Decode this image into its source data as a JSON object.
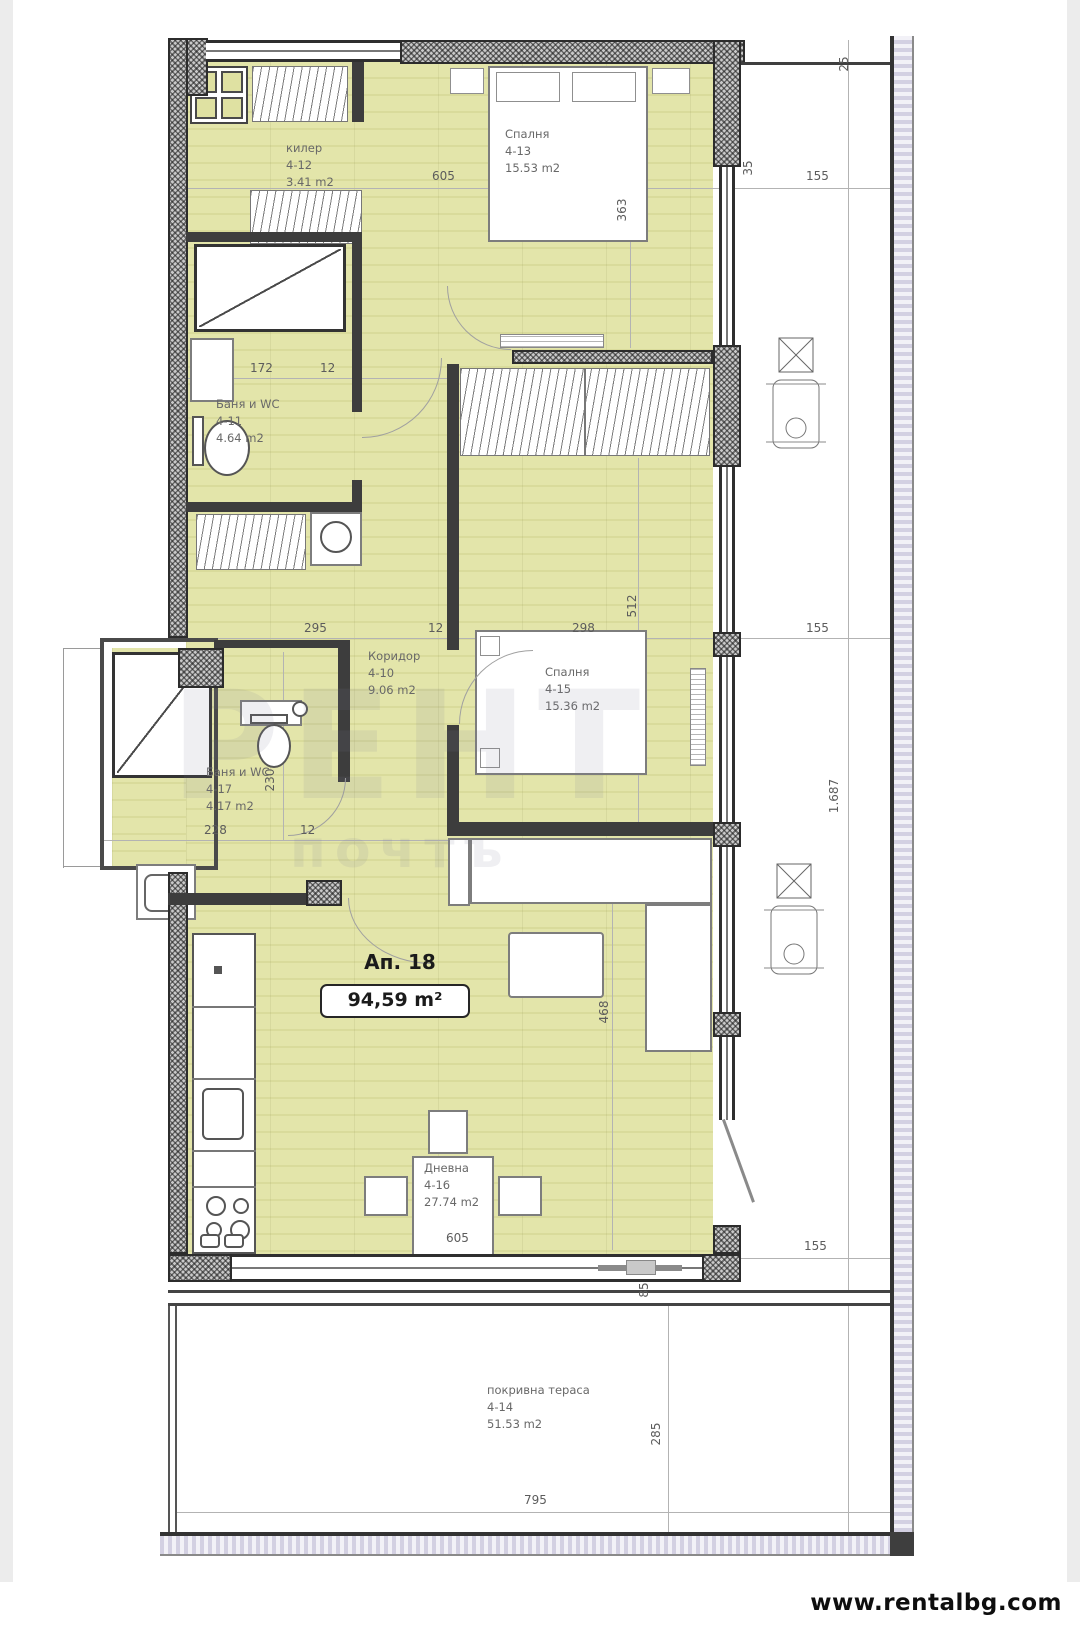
{
  "apartment": {
    "label": "Ап. 18",
    "area": "94,59 m²"
  },
  "rooms": [
    {
      "name": "килер",
      "code": "4-12",
      "area": "3.41 m2"
    },
    {
      "name": "Спалня",
      "code": "4-13",
      "area": "15.53 m2"
    },
    {
      "name": "Баня и WC",
      "code": "4-11",
      "area": "4.64 m2"
    },
    {
      "name": "Коридор",
      "code": "4-10",
      "area": "9.06 m2"
    },
    {
      "name": "Спалня",
      "code": "4-15",
      "area": "15.36 m2"
    },
    {
      "name": "Баня и WC",
      "code": "4-17",
      "area": "4.17 m2"
    },
    {
      "name": "Дневна",
      "code": "4-16",
      "area": "27.74 m2"
    },
    {
      "name": "покривна тераса",
      "code": "4-14",
      "area": "51.53 m2"
    }
  ],
  "dims": {
    "w_top": "605",
    "gap35": "35",
    "m155_top": "155",
    "m25": "25",
    "h363": "363",
    "w172": "172",
    "d12_a": "12",
    "w295": "295",
    "d12_b": "12",
    "w298": "298",
    "h512": "512",
    "m155_mid": "155",
    "w228": "228",
    "d12_c": "12",
    "h230": "230",
    "h468": "468",
    "w_bottom": "605",
    "h85": "85",
    "m155_low": "155",
    "h1687": "1.687",
    "h285": "285",
    "w795": "795"
  },
  "watermark": {
    "big": "РЕНТ",
    "small": "почтъ"
  },
  "footer": {
    "url": "www.rentalbg.com"
  },
  "colors": {
    "floor": "#dfe1a2",
    "wall": "#3d3d3d",
    "dim_line": "#b3b3b3",
    "rail": "#d3d0e2",
    "url_text": "#0e0e0e"
  }
}
